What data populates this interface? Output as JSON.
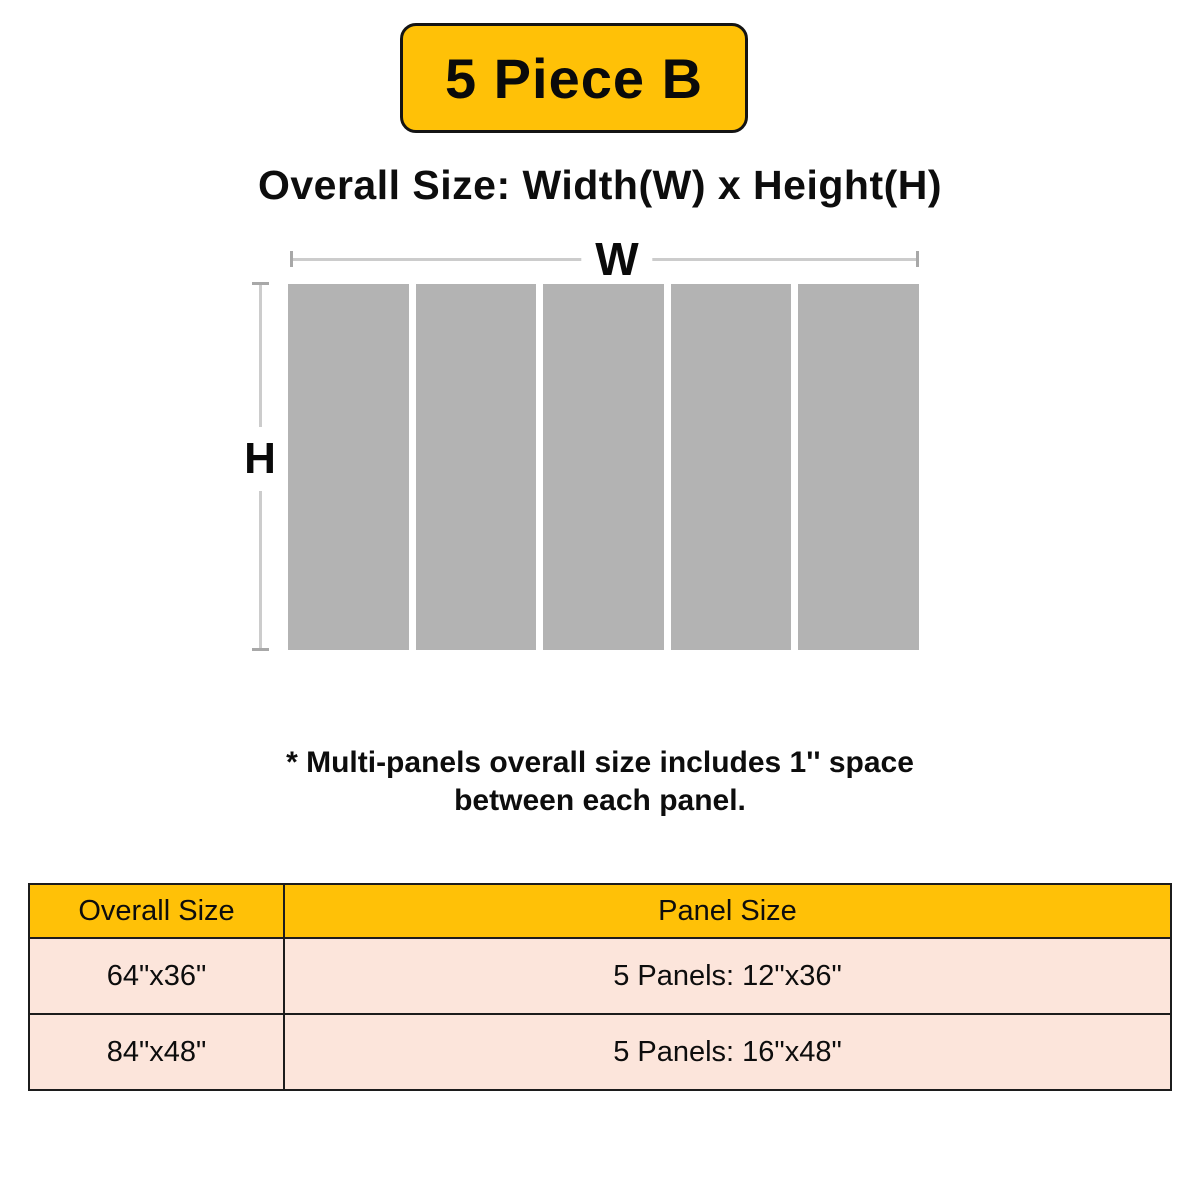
{
  "badge": {
    "label": "5 Piece B"
  },
  "title": "Overall Size: Width(W) x Height(H)",
  "diagram": {
    "width_label": "W",
    "height_label": "H",
    "panel_count": 5,
    "panel_color": "#B3B3B3",
    "dim_line_color": "#CCCCCC"
  },
  "note": {
    "line1": "* Multi-panels overall size includes 1'' space",
    "line2": "between each panel."
  },
  "table": {
    "headers": [
      "Overall Size",
      "Panel Size"
    ],
    "rows": [
      [
        "64\"x36\"",
        "5 Panels: 12\"x36\""
      ],
      [
        "84\"x48\"",
        "5 Panels: 16\"x48\""
      ]
    ]
  },
  "colors": {
    "accent_yellow": "#FFC107",
    "row_pink": "#FCE5DB",
    "border_dark": "#1C1C1C"
  }
}
